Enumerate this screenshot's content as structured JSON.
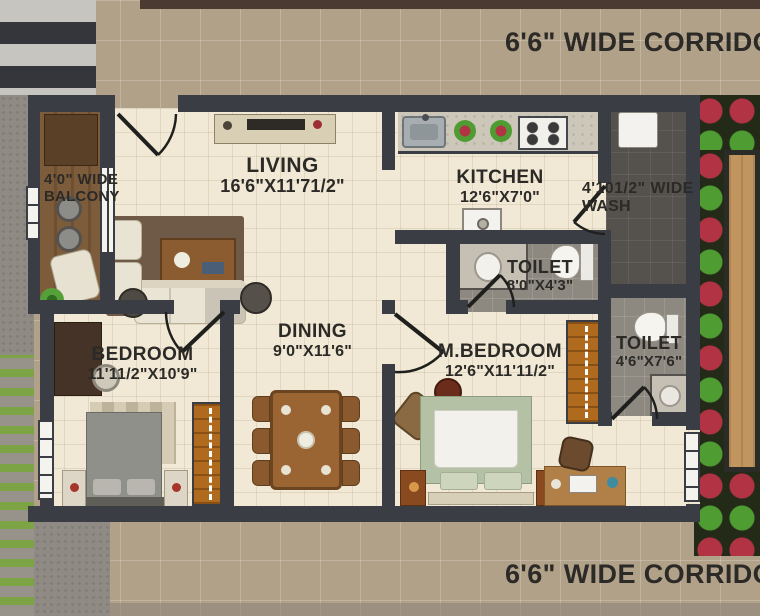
{
  "corridors": {
    "top": "6'6\" WIDE CORRIDOR",
    "bottom": "6'6\" WIDE CORRIDOR"
  },
  "rooms": {
    "balcony": {
      "line1": "4'0\" WIDE",
      "line2": "BALCONY"
    },
    "living": {
      "name": "LIVING",
      "dims": "16'6\"X11'71/2\""
    },
    "kitchen": {
      "name": "KITCHEN",
      "dims": "12'6\"X7'0\""
    },
    "wash": {
      "line1": "4'101/2\" WIDE",
      "line2": "WASH"
    },
    "toilet_common": {
      "name": "TOILET",
      "dims": "8'0\"X4'3\""
    },
    "dining": {
      "name": "DINING",
      "dims": "9'0\"X11'6\""
    },
    "bedroom": {
      "name": "BEDROOM",
      "dims": "11'11/2\"X10'9\""
    },
    "master_bedroom": {
      "name": "M.BEDROOM",
      "dims": "12'6\"X11'11/2\""
    },
    "toilet_master": {
      "name": "TOILET",
      "dims": "4'6\"X7'6\""
    }
  },
  "colors": {
    "wall": "#3a3e44",
    "floor_tile": "#f1e9d6",
    "corridor": "#b2a189",
    "balcony_wood": "#7b5a3a",
    "wash_floor": "#55524d",
    "toilet_floor": "#8d8981",
    "wardrobe": "#b06a1e",
    "deck": "#c2955f",
    "grass": "#7ca344",
    "flower_red": "#b13344",
    "leaf_green": "#4f9c33",
    "label_text": "#2b2a27"
  }
}
